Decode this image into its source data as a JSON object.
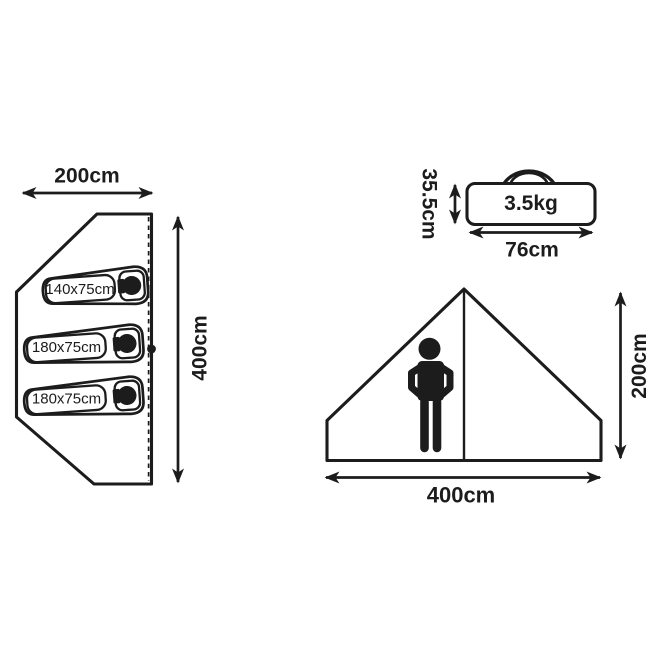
{
  "page": {
    "background_color": "#ffffff",
    "ink_color": "#1c1c1c",
    "description_labels_only": true
  },
  "floorplan": {
    "width_label": "200cm",
    "length_label": "400cm",
    "beds": [
      {
        "label": "140x75cm"
      },
      {
        "label": "180x75cm"
      },
      {
        "label": "180x75cm"
      }
    ]
  },
  "carry_bag": {
    "weight_label": "3.5kg",
    "height_label": "35.5cm",
    "width_label": "76cm"
  },
  "front_view": {
    "height_label": "200cm",
    "width_label": "400cm"
  },
  "icons": {
    "person": "person-silhouette-icon",
    "sleeping_bag": "sleeping-bag-icon",
    "carry_bag_handle": "bag-handle-icon",
    "door_pull": "door-pull-dot"
  }
}
